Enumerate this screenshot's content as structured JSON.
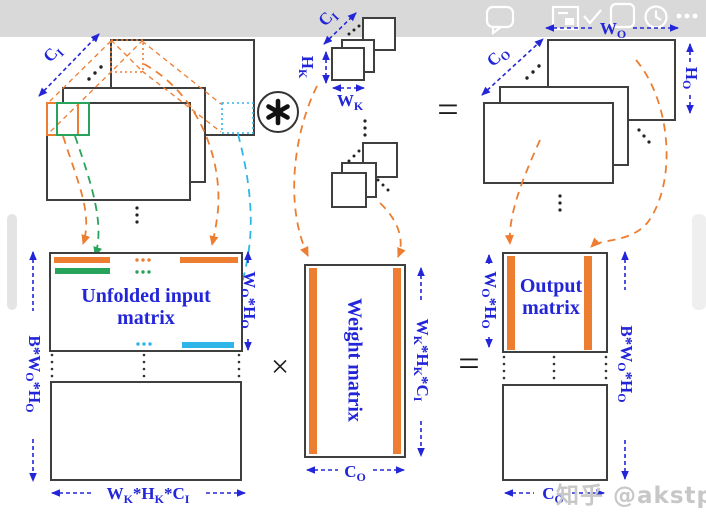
{
  "topbar": {
    "bg_color": "#d9d9d9",
    "icons": [
      "comment-icon",
      "float-window-icon",
      "check-icon",
      "app-frame-icon",
      "clock-icon",
      "more-icon"
    ]
  },
  "side_handles": {
    "left": "scroll-handle",
    "right": "scroll-handle"
  },
  "colors": {
    "label_blue": "#2326d8",
    "orange": "#ed7d31",
    "green": "#27a35c",
    "cyan": "#2eb6e9",
    "outline_gray": "#3f3f3f",
    "watermark_gray": "#c7c7c7"
  },
  "labels": {
    "ci": {
      "base": "C",
      "sub": "I"
    },
    "co": {
      "base": "C",
      "sub": "O"
    },
    "wo": {
      "base": "W",
      "sub": "O"
    },
    "ho": {
      "base": "H",
      "sub": "O"
    },
    "wk": {
      "base": "W",
      "sub": "K"
    },
    "hk": {
      "base": "H",
      "sub": "K"
    },
    "b_wo_ho": {
      "p1": "B*W",
      "s1": "O",
      "p2": "*H",
      "s2": "O"
    },
    "wo_ho": {
      "p1": "W",
      "s1": "O",
      "p2": "*H",
      "s2": "O"
    },
    "wk_hk_ci": {
      "p1": "W",
      "s1": "K",
      "p2": "*H",
      "s2": "K",
      "p3": "*C",
      "s3": "I"
    }
  },
  "matrices": {
    "unfolded": {
      "line1": "Unfolded input",
      "line2": "matrix"
    },
    "weight": {
      "label": "Weight matrix"
    },
    "output": {
      "line1": "Output",
      "line2": "matrix"
    }
  },
  "operators": {
    "convolution": "asterisk",
    "multiply": "×",
    "equals": "="
  },
  "watermark": {
    "text": "知乎 @akstpo"
  }
}
